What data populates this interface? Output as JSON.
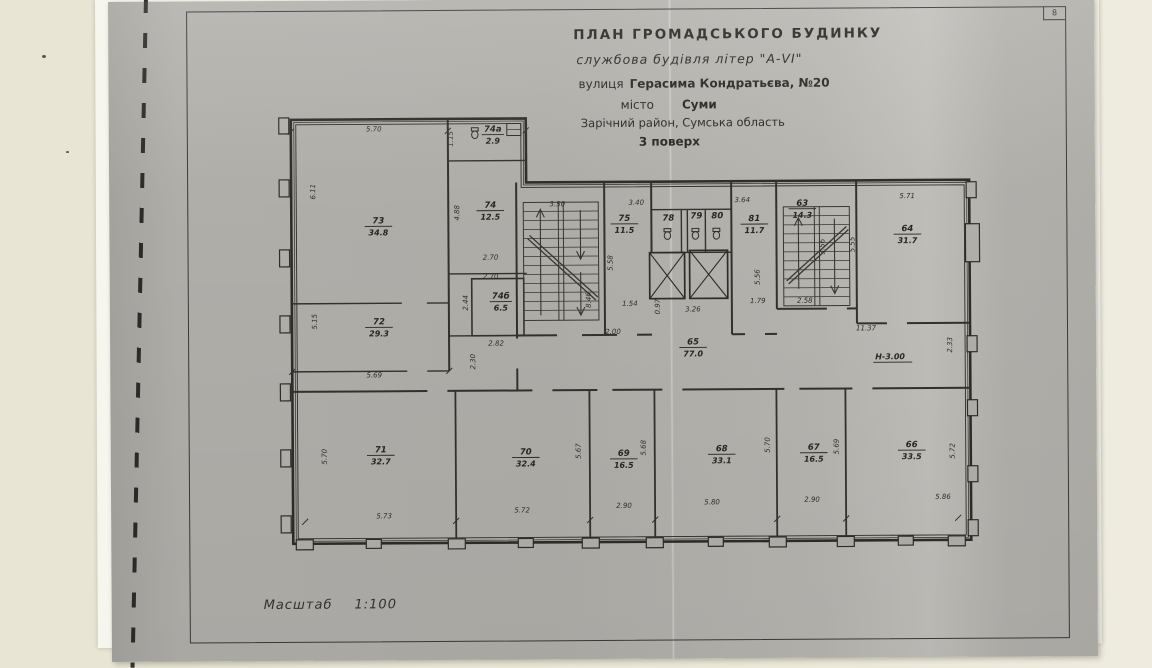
{
  "page": {
    "number": "8",
    "title": {
      "line1": "ПЛАН  ГРОМАДСЬКОГО  БУДИНКУ",
      "line2": "службова будівля літер \"А-VI\"",
      "line3_prefix": "вулиця",
      "line3_value": "Герасима Кондратьєва, №20",
      "line4_prefix": "місто",
      "line4_value": "Суми",
      "line5": "Зарічний район, Сумська область",
      "line6": "3 поверх"
    },
    "scale_label": "Масштаб",
    "scale_value": "1:100",
    "height_note": "Н-3.00"
  },
  "plan": {
    "rooms": [
      {
        "number": "73",
        "area": "34.8"
      },
      {
        "number": "74а",
        "area": "2.9"
      },
      {
        "number": "74",
        "area": "12.5"
      },
      {
        "number": "74б",
        "area": "6.5"
      },
      {
        "number": "72",
        "area": "29.3"
      },
      {
        "number": "75",
        "area": "11.5"
      },
      {
        "number": "78",
        "area": ""
      },
      {
        "number": "79",
        "area": ""
      },
      {
        "number": "80",
        "area": ""
      },
      {
        "number": "81",
        "area": "11.7"
      },
      {
        "number": "63",
        "area": "14.3"
      },
      {
        "number": "64",
        "area": "31.7"
      },
      {
        "number": "65",
        "area": "77.0"
      },
      {
        "number": "71",
        "area": "32.7"
      },
      {
        "number": "70",
        "area": "32.4"
      },
      {
        "number": "69",
        "area": "16.5"
      },
      {
        "number": "68",
        "area": "33.1"
      },
      {
        "number": "67",
        "area": "16.5"
      },
      {
        "number": "66",
        "area": "33.5"
      }
    ],
    "dims": [
      "5.70",
      "1.15",
      "6.11",
      "4.88",
      "2.70",
      "2.70",
      "2.44",
      "2.82",
      "2.30",
      "5.15",
      "5.69",
      "3.50",
      "8.46",
      "3.40",
      "5.58",
      "1.54",
      "2.00",
      "0.97",
      "3.26",
      "3.64",
      "5.56",
      "1.79",
      "3.56",
      "2.58",
      "5.71",
      "5.55",
      "11.37",
      "2.33",
      "5.70",
      "5.73",
      "5.72",
      "5.67",
      "5.68",
      "2.90",
      "5.80",
      "5.70",
      "2.90",
      "5.69",
      "5.86",
      "5.72"
    ]
  },
  "colors": {
    "wall_background": "#e9e6d6",
    "paper_edge": "#f7f6ee",
    "photocopy_gray": "#b3b1ac",
    "ink": "#34322e"
  }
}
